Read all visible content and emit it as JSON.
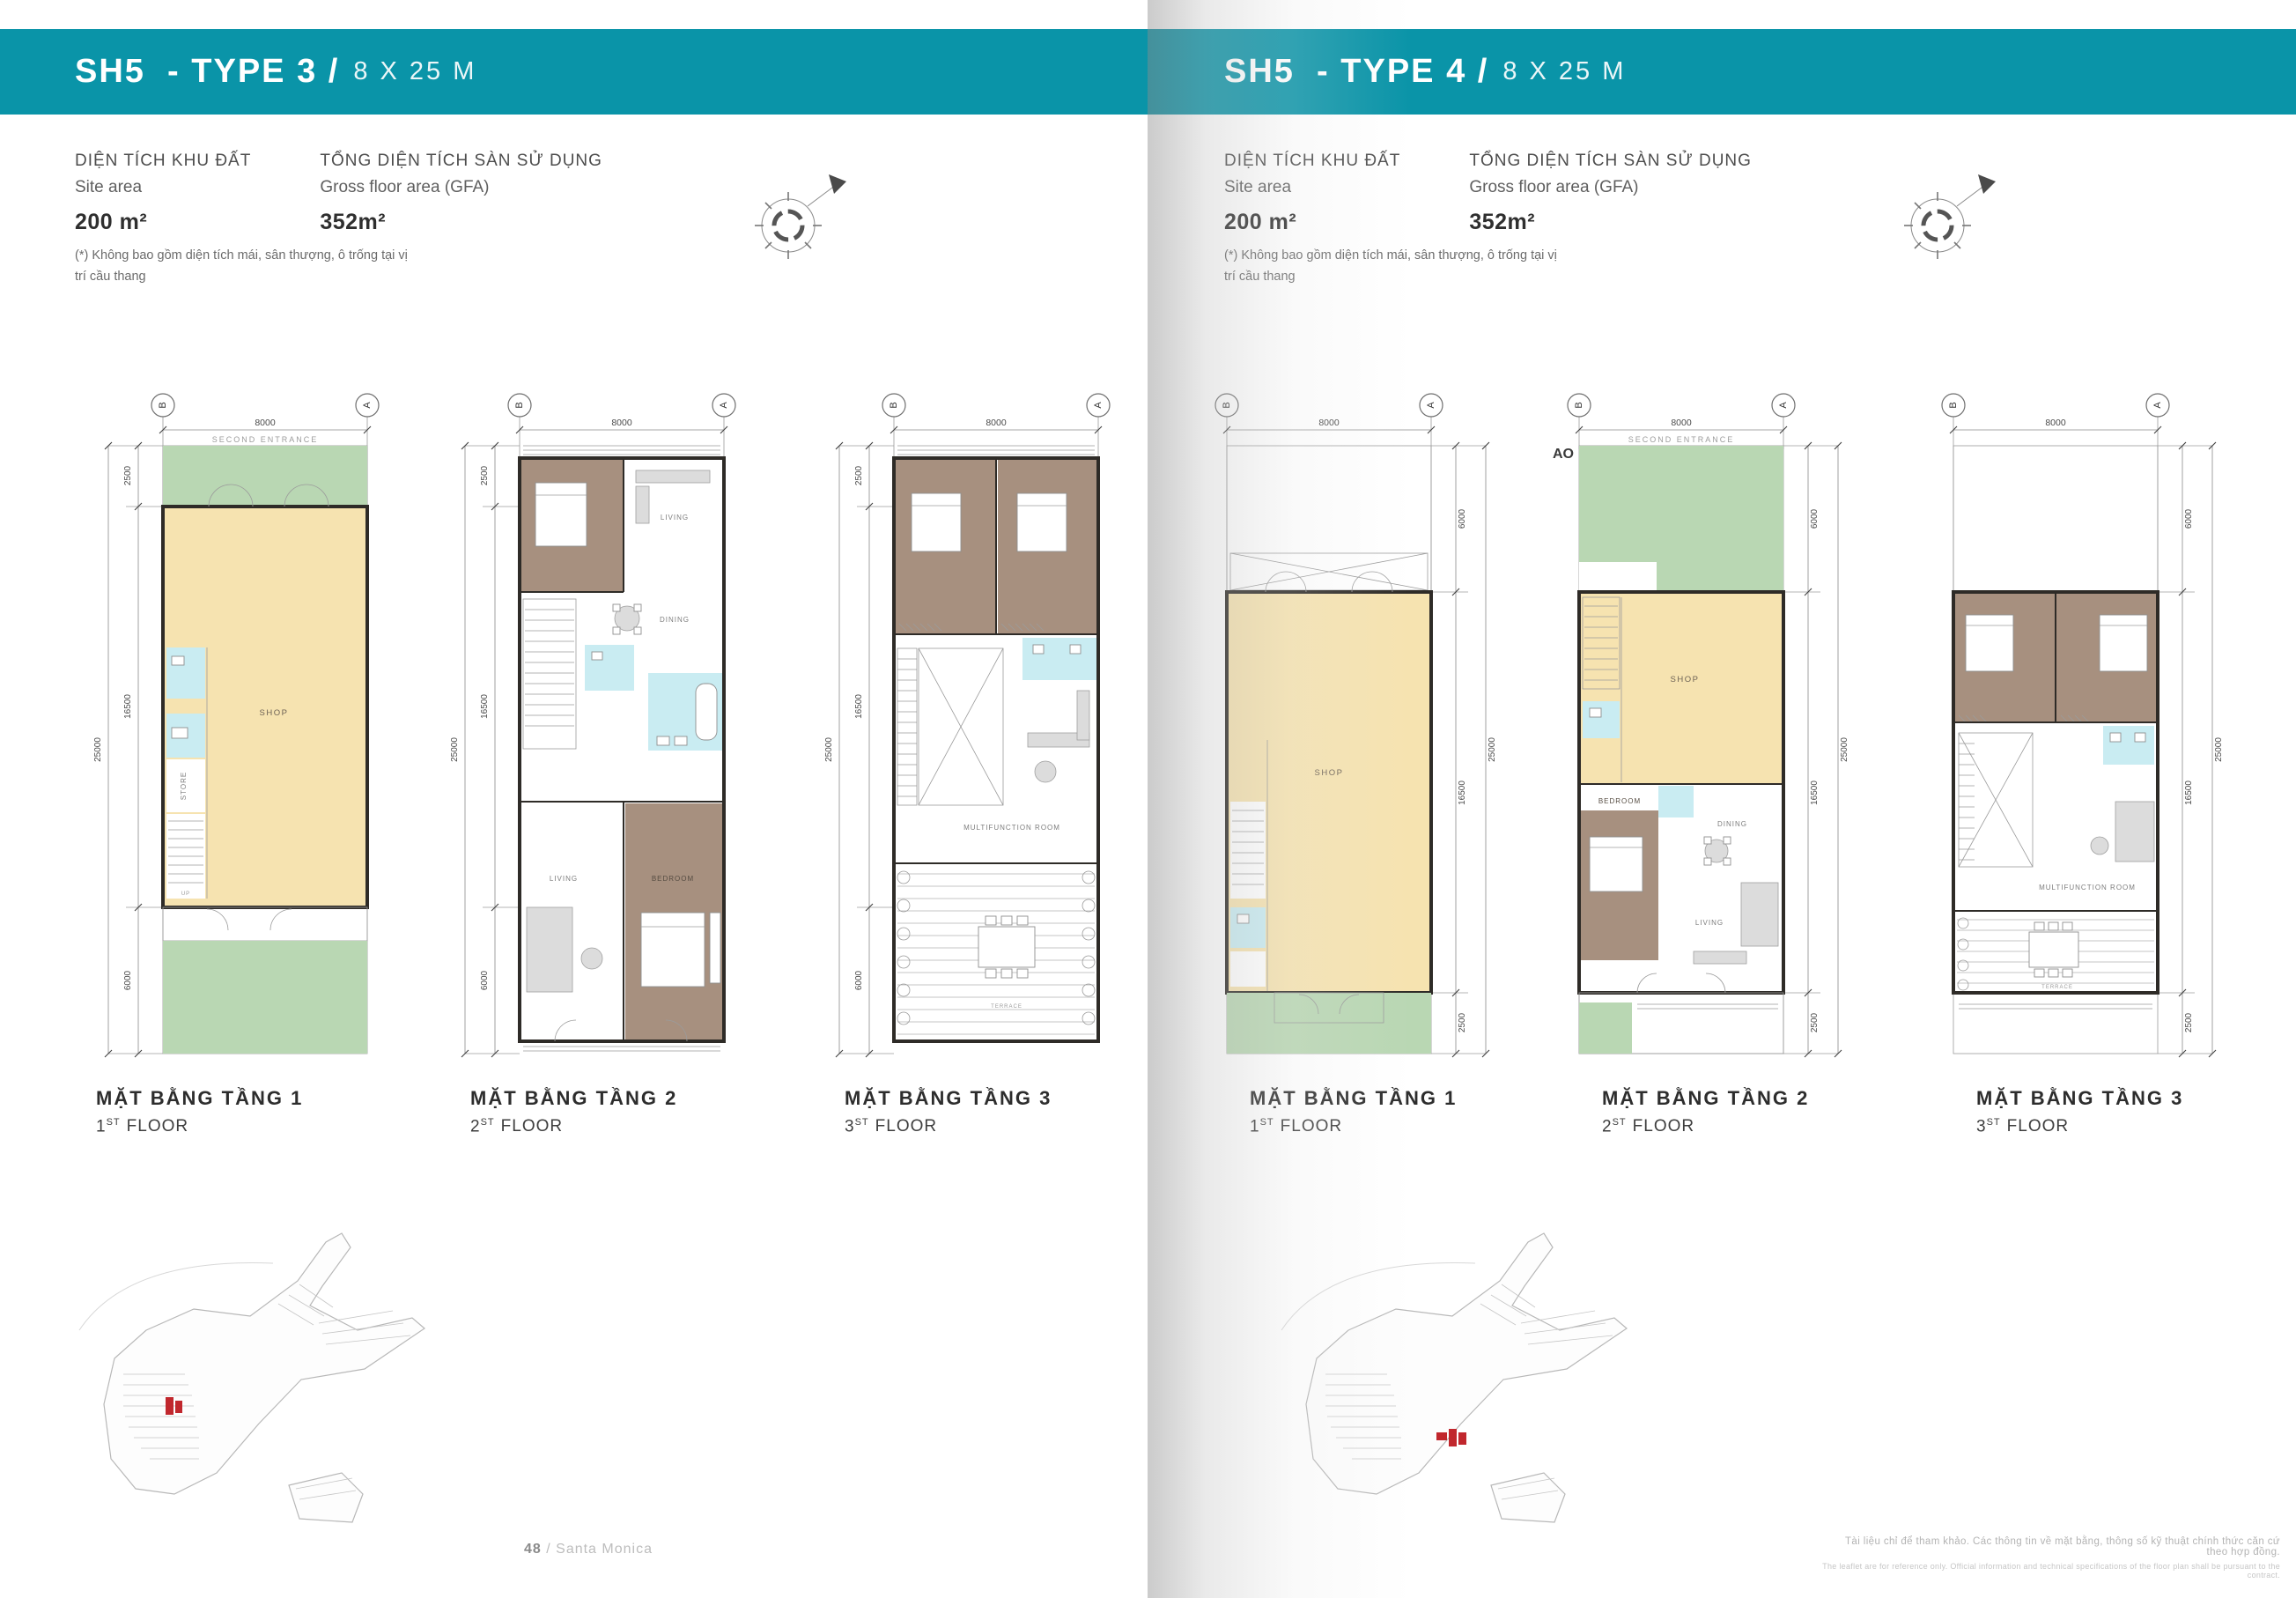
{
  "colors": {
    "teal": "#0a94a8",
    "green": "#b9d7b3",
    "cream": "#f6e3b0",
    "blue": "#c9ecf2",
    "brown": "#a7907f",
    "wall": "#2e2b27",
    "red": "#c1272d"
  },
  "footer": {
    "page_number": "48",
    "separator": " / ",
    "project": "Santa Monica"
  },
  "fineprint": {
    "vi": "Tài liệu chỉ để tham khảo. Các thông tin về mặt bằng, thông số kỹ thuật chính thức căn cứ theo hợp đồng.",
    "en": "The leaflet are for reference only. Official information and technical specifications of the floor plan shall be pursuant to the contract."
  },
  "pages": [
    {
      "title": {
        "code": "SH5",
        "type_part": "- TYPE 3 /",
        "size_part": "8 X 25 M"
      },
      "site_area": {
        "label_vi": "DIỆN TÍCH KHU ĐẤT",
        "label_en": "Site area",
        "value": "200 m²"
      },
      "gfa": {
        "label_vi": "TỔNG DIỆN TÍCH SÀN SỬ DỤNG",
        "label_en": "Gross floor area (GFA)",
        "value": "352m²"
      },
      "footnote_line1": "(*) Không bao gồm diện tích mái, sân thượng, ô trống tại vị",
      "footnote_line2": "trí cầu thang",
      "plans": [
        {
          "name_vi": "MẶT BẰNG TẦNG 1",
          "floor_num": "1",
          "floor_sup": "ST",
          "floor_word": "FLOOR",
          "bubble_left": "B",
          "bubble_right": "A",
          "dim_width": "8000",
          "dim_total": "25000",
          "seg_a": "2500",
          "seg_b": "16500",
          "seg_c": "6000",
          "entrance_label": "SECOND ENTRANCE",
          "room_shop": "SHOP",
          "room_store": "STORE",
          "stairs_label": "UP"
        },
        {
          "name_vi": "MẶT BẰNG TẦNG 2",
          "floor_num": "2",
          "floor_sup": "ST",
          "floor_word": "FLOOR",
          "bubble_left": "B",
          "bubble_right": "A",
          "dim_width": "8000",
          "dim_total": "25000",
          "seg_a": "2500",
          "seg_b": "16500",
          "seg_c": "6000",
          "room_living1": "LIVING",
          "room_dining": "DINING",
          "room_living2": "LIVING",
          "room_bedroom": "BEDROOM"
        },
        {
          "name_vi": "MẶT BẰNG TẦNG 3",
          "floor_num": "3",
          "floor_sup": "ST",
          "floor_word": "FLOOR",
          "bubble_left": "B",
          "bubble_right": "A",
          "dim_width": "8000",
          "dim_total": "25000",
          "seg_a": "2500",
          "seg_b": "16500",
          "seg_c": "6000",
          "room_multi": "MULTIFUNCTION  ROOM",
          "room_terrace": "TERRACE"
        }
      ]
    },
    {
      "title": {
        "code": "SH5",
        "type_part": "- TYPE 4 /",
        "size_part": "8 X 25 M"
      },
      "site_area": {
        "label_vi": "DIỆN TÍCH KHU ĐẤT",
        "label_en": "Site area",
        "value": "200 m²"
      },
      "gfa": {
        "label_vi": "TỔNG DIỆN TÍCH SÀN SỬ DỤNG",
        "label_en": "Gross floor area (GFA)",
        "value": "352m²"
      },
      "footnote_line1": "(*) Không bao gồm diện tích mái, sân thượng, ô trống tại vị",
      "footnote_line2": "trí cầu thang",
      "plans": [
        {
          "name_vi": "MẶT BẰNG TẦNG 1",
          "floor_num": "1",
          "floor_sup": "ST",
          "floor_word": "FLOOR",
          "bubble_left": "B",
          "bubble_right": "A",
          "dim_width": "8000",
          "dim_total": "25000",
          "seg_a": "6000",
          "seg_b": "16500",
          "seg_c": "2500",
          "room_shop": "SHOP"
        },
        {
          "name_vi": "MẶT BẰNG TẦNG 2",
          "floor_num": "2",
          "floor_sup": "ST",
          "floor_word": "FLOOR",
          "bubble_left": "B",
          "bubble_right": "A",
          "dim_width": "8000",
          "dim_total": "25000",
          "seg_a": "6000",
          "seg_b": "16500",
          "seg_c": "2500",
          "ao_label": "AO",
          "entrance_label": "SECOND ENTRANCE",
          "room_shop": "SHOP",
          "room_dining": "DINING",
          "room_living": "LIVING",
          "room_bedroom": "BEDROOM"
        },
        {
          "name_vi": "MẶT BẰNG TẦNG 3",
          "floor_num": "3",
          "floor_sup": "ST",
          "floor_word": "FLOOR",
          "bubble_left": "B",
          "bubble_right": "A",
          "dim_width": "8000",
          "dim_total": "25000",
          "seg_a": "6000",
          "seg_b": "16500",
          "seg_c": "2500",
          "room_multi": "MULTIFUNCTION  ROOM",
          "room_terrace": "TERRACE"
        }
      ]
    }
  ]
}
